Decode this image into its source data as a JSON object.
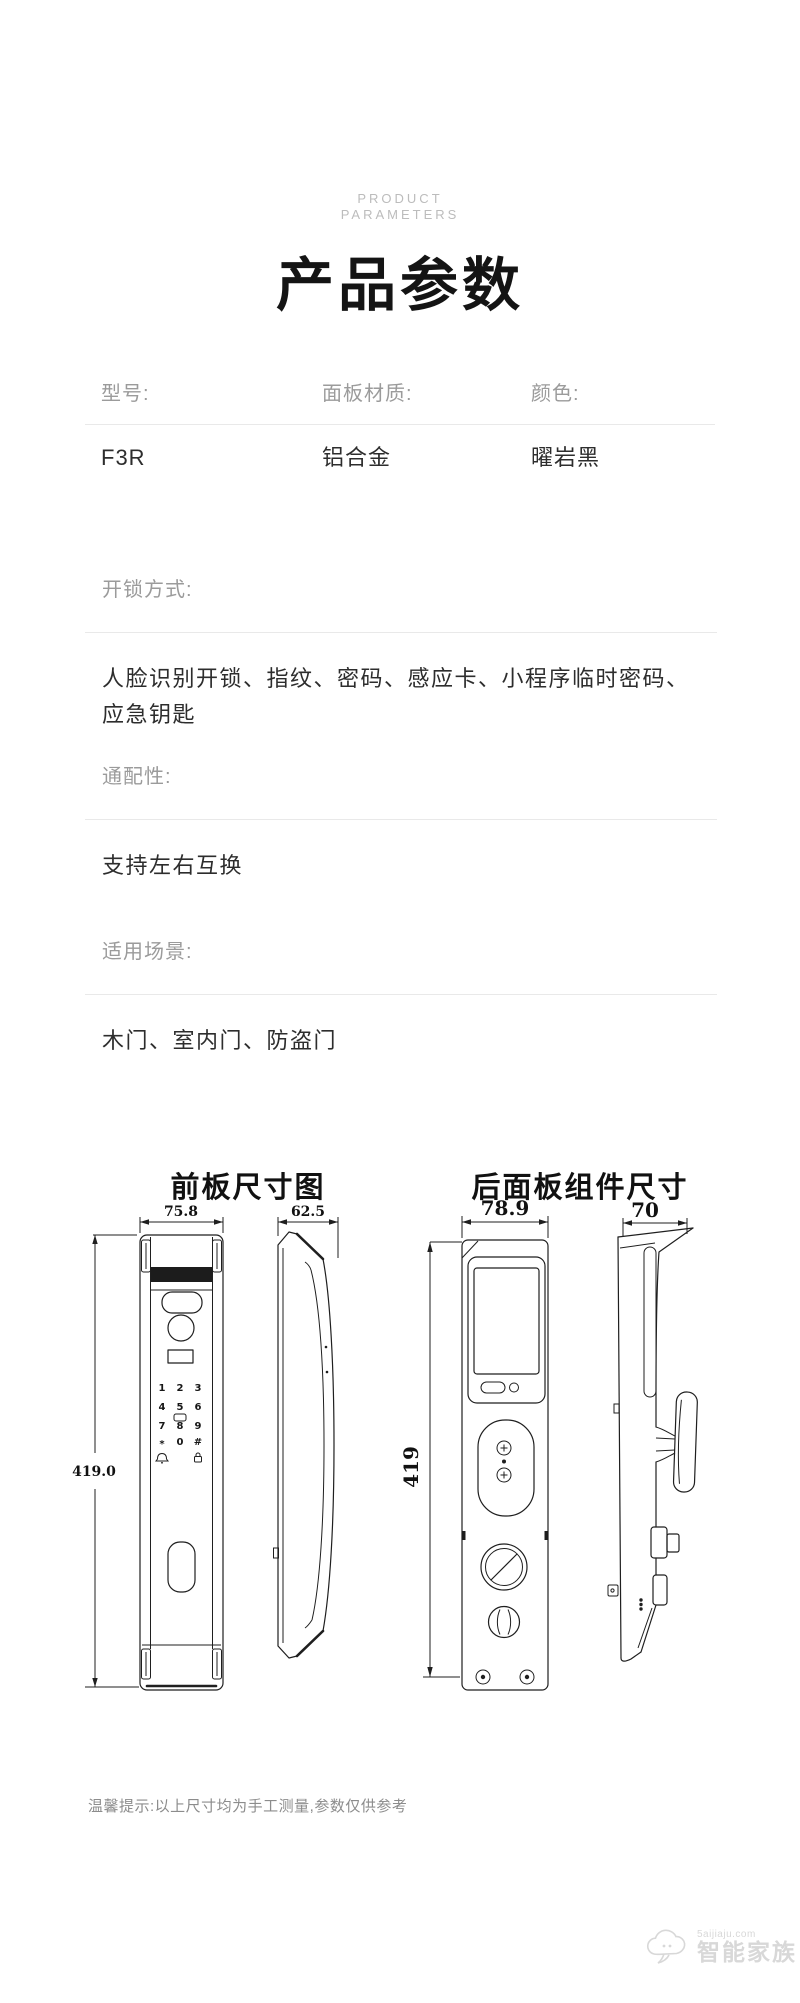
{
  "page": {
    "eyebrow": [
      "PRODUCT",
      "PARAMETERS"
    ],
    "title": "产品参数"
  },
  "spec_table": {
    "columns": [
      {
        "label": "型号:",
        "value": "F3R"
      },
      {
        "label": "面板材质:",
        "value": "铝合金"
      },
      {
        "label": "颜色:",
        "value": "曜岩黑"
      }
    ]
  },
  "sections": [
    {
      "label": "开锁方式:",
      "value": "人脸识别开锁、指纹、密码、感应卡、小程序临时密码、应急钥匙"
    },
    {
      "label": "通配性:",
      "value": "支持左右互换"
    },
    {
      "label": "适用场景:",
      "value": "木门、室内门、防盗门"
    }
  ],
  "diagrams": {
    "front_panel": {
      "title": "前板尺寸图",
      "front_width": "75.8",
      "side_width": "62.5",
      "height": "419.0",
      "keypad": [
        "1",
        "2",
        "3",
        "4",
        "5",
        "6",
        "7",
        "8",
        "9",
        "*",
        "0",
        "#"
      ]
    },
    "rear_panel": {
      "title": "后面板组件尺寸",
      "front_width": "78.9",
      "side_width": "70",
      "height": "419"
    }
  },
  "footer": {
    "tip": "温馨提示:以上尺寸均为手工测量,参数仅供参考"
  },
  "watermark": {
    "site": "5aijiaju.com",
    "name": "智能家族"
  },
  "colors": {
    "line": "#1f1f1f",
    "label_gray": "#9b9b9b",
    "rule": "#e9e9e9",
    "eyebrow_gray": "#bcbcbc"
  }
}
